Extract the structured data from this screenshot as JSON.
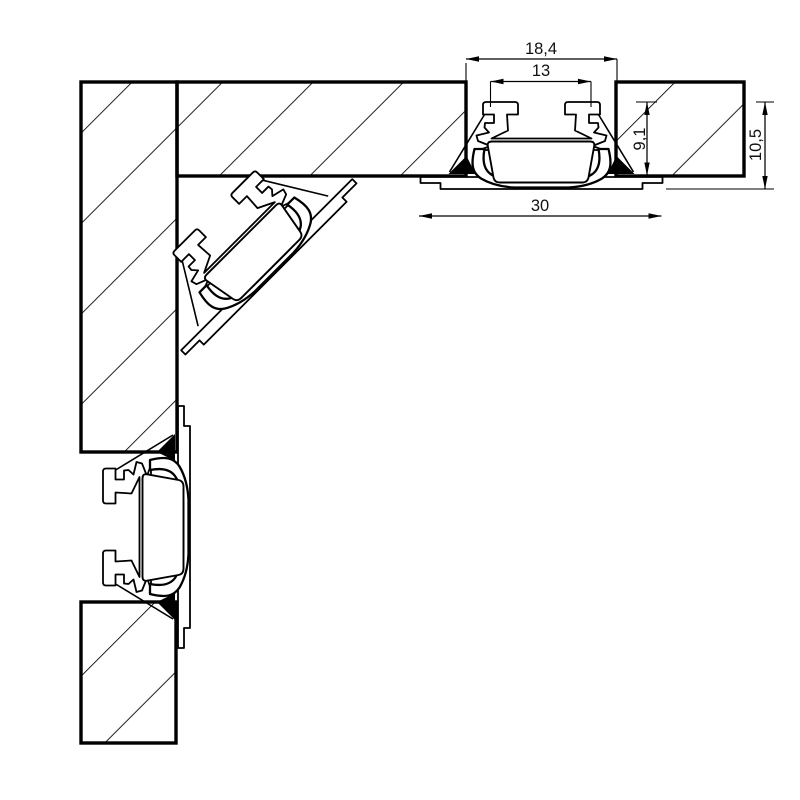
{
  "drawing": {
    "dimensions": {
      "recess_width": "18,4",
      "inner_width": "13",
      "recess_depth": "9,1",
      "total_height": "10,5",
      "flange_width": "30"
    }
  },
  "colors": {
    "line": "#000000",
    "background": "#ffffff",
    "extension_gray": "#a3a3a3"
  }
}
